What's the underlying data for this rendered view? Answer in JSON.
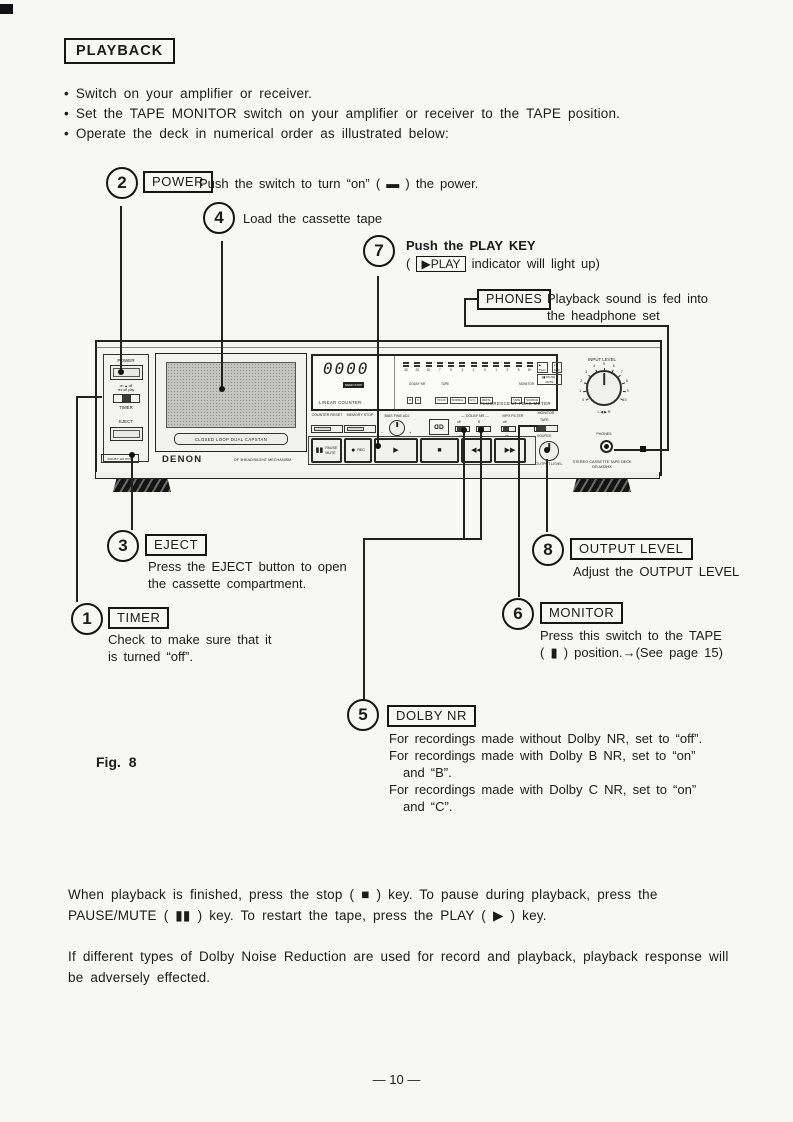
{
  "header": {
    "title": "PLAYBACK",
    "bullets": [
      "Switch on your amplifier or receiver.",
      "Set the TAPE MONITOR switch on your amplifier or receiver to the TAPE position.",
      "Operate the deck in numerical order as illustrated below:"
    ]
  },
  "callouts": {
    "power": {
      "num": "2",
      "label": "POWER",
      "text": "Push the switch to turn “on” ( ▬ ) the power."
    },
    "load": {
      "num": "4",
      "text": "Load the cassette tape"
    },
    "play": {
      "num": "7",
      "title": "Push the PLAY KEY",
      "pre": "(",
      "indicator": "▶PLAY",
      "post": "indicator will light up)"
    },
    "phones": {
      "label": "PHONES",
      "line1": "Playback sound is fed into",
      "line2": "the headphone set"
    },
    "eject": {
      "num": "3",
      "label": "EJECT",
      "line1": "Press the EJECT button to open",
      "line2": "the cassette compartment."
    },
    "timer": {
      "num": "1",
      "label": "TIMER",
      "line1": "Check to make sure that it",
      "line2": "is turned “off”."
    },
    "output_level": {
      "num": "8",
      "label": "OUTPUT LEVEL",
      "text": "Adjust the OUTPUT LEVEL"
    },
    "monitor": {
      "num": "6",
      "label": "MONITOR",
      "line1": "Press this switch to the TAPE",
      "line2": "( ▮ ) position.→(See page 15)"
    },
    "dolby": {
      "num": "5",
      "label": "DOLBY NR",
      "lines": [
        "For recordings made without Dolby NR, set to “off”.",
        "For recordings made with Dolby B NR, set to “on”",
        "and “B”.",
        "For recordings made with Dolby C NR, set to “on”",
        "and “C”."
      ]
    }
  },
  "deck": {
    "left": {
      "power_label": "POWER",
      "timer_line1": "on ▲ off",
      "timer_line2": "rec off play",
      "timer_label": "TIMER",
      "eject_label": "EJECT",
      "badge": "DOLBY HX PRO"
    },
    "door": {
      "capstan": "CLOSED LOOP DUAL CAPSTAN",
      "brand": "DENON",
      "mech": "DF 3HEAD/SILENT MECHANISM"
    },
    "display": {
      "counter": "0000",
      "memo_badge": "MEMO STOP",
      "linear_label": "LINEAR COUNTER",
      "meter_scale": [
        "30",
        "20",
        "10",
        "7",
        "5",
        "3",
        "1",
        "0",
        "1",
        "3",
        "5",
        "8+"
      ],
      "ind_play": "▶ PLAY",
      "ind_rec": "● REC",
      "ind_pause": "▮▮ PAUSE / MUTE",
      "dolby_label": "DOLBY NR",
      "dolby_boxes": [
        "B",
        "C"
      ],
      "tape_label": "TAPE",
      "tape_boxes": [
        "70/120",
        "NORMAL",
        "CrO₂",
        "METAL"
      ],
      "monitor_label": "MONITOR",
      "monitor_boxes": [
        "TAPE",
        "SOURCE"
      ],
      "fluor_label": "FLUORESCENT PEAK METER"
    },
    "controls": {
      "counter_reset": "COUNTER RESET",
      "memory_stop": "MEMORY STOP",
      "bias_label": "BIAS FINE ADJ",
      "minus": "−",
      "plus": "+",
      "dolby_header": "— DOLBY NR —",
      "mpx_header": "MPX FILTER",
      "switches": [
        {
          "top": "off",
          "bottom": "on"
        },
        {
          "top": "B",
          "bottom": "C"
        },
        {
          "top": "off",
          "bottom": "on"
        }
      ],
      "monitor_label": "MONITOR",
      "monitor_top": "TAPE",
      "monitor_bottom": "SOURCE"
    },
    "transport": {
      "buttons": [
        {
          "glyph": "▮▮",
          "label": "PAUSE MUTE"
        },
        {
          "glyph": "●",
          "label": "REC"
        },
        {
          "glyph": "▶",
          "label": ""
        },
        {
          "glyph": "■",
          "label": ""
        },
        {
          "glyph": "◀◀",
          "label": ""
        },
        {
          "glyph": "▶▶",
          "label": ""
        }
      ],
      "output_label": "OUTPUT LEVEL"
    },
    "right": {
      "input_label": "INPUT LEVEL",
      "ticks": [
        "0",
        "1",
        "2",
        "3",
        "4",
        "5",
        "6",
        "7",
        "8",
        "9",
        "10"
      ],
      "balance": "L ◀ ▶ R",
      "phones_label": "PHONES",
      "model_line1": "STEREO CASSETTE TAPE DECK",
      "model_line2": "DR-M33HX"
    }
  },
  "figure_label": "Fig. 8",
  "footer": {
    "para1": "When playback is finished, press the stop ( ■ ) key.  To pause during playback, press the PAUSE/MUTE ( ▮▮ ) key.  To restart the tape, press the PLAY ( ▶ ) key.",
    "para2": "If different types of Dolby Noise Reduction are used for record and playback, playback response will be adversely effected.",
    "page_number": "— 10 —"
  }
}
